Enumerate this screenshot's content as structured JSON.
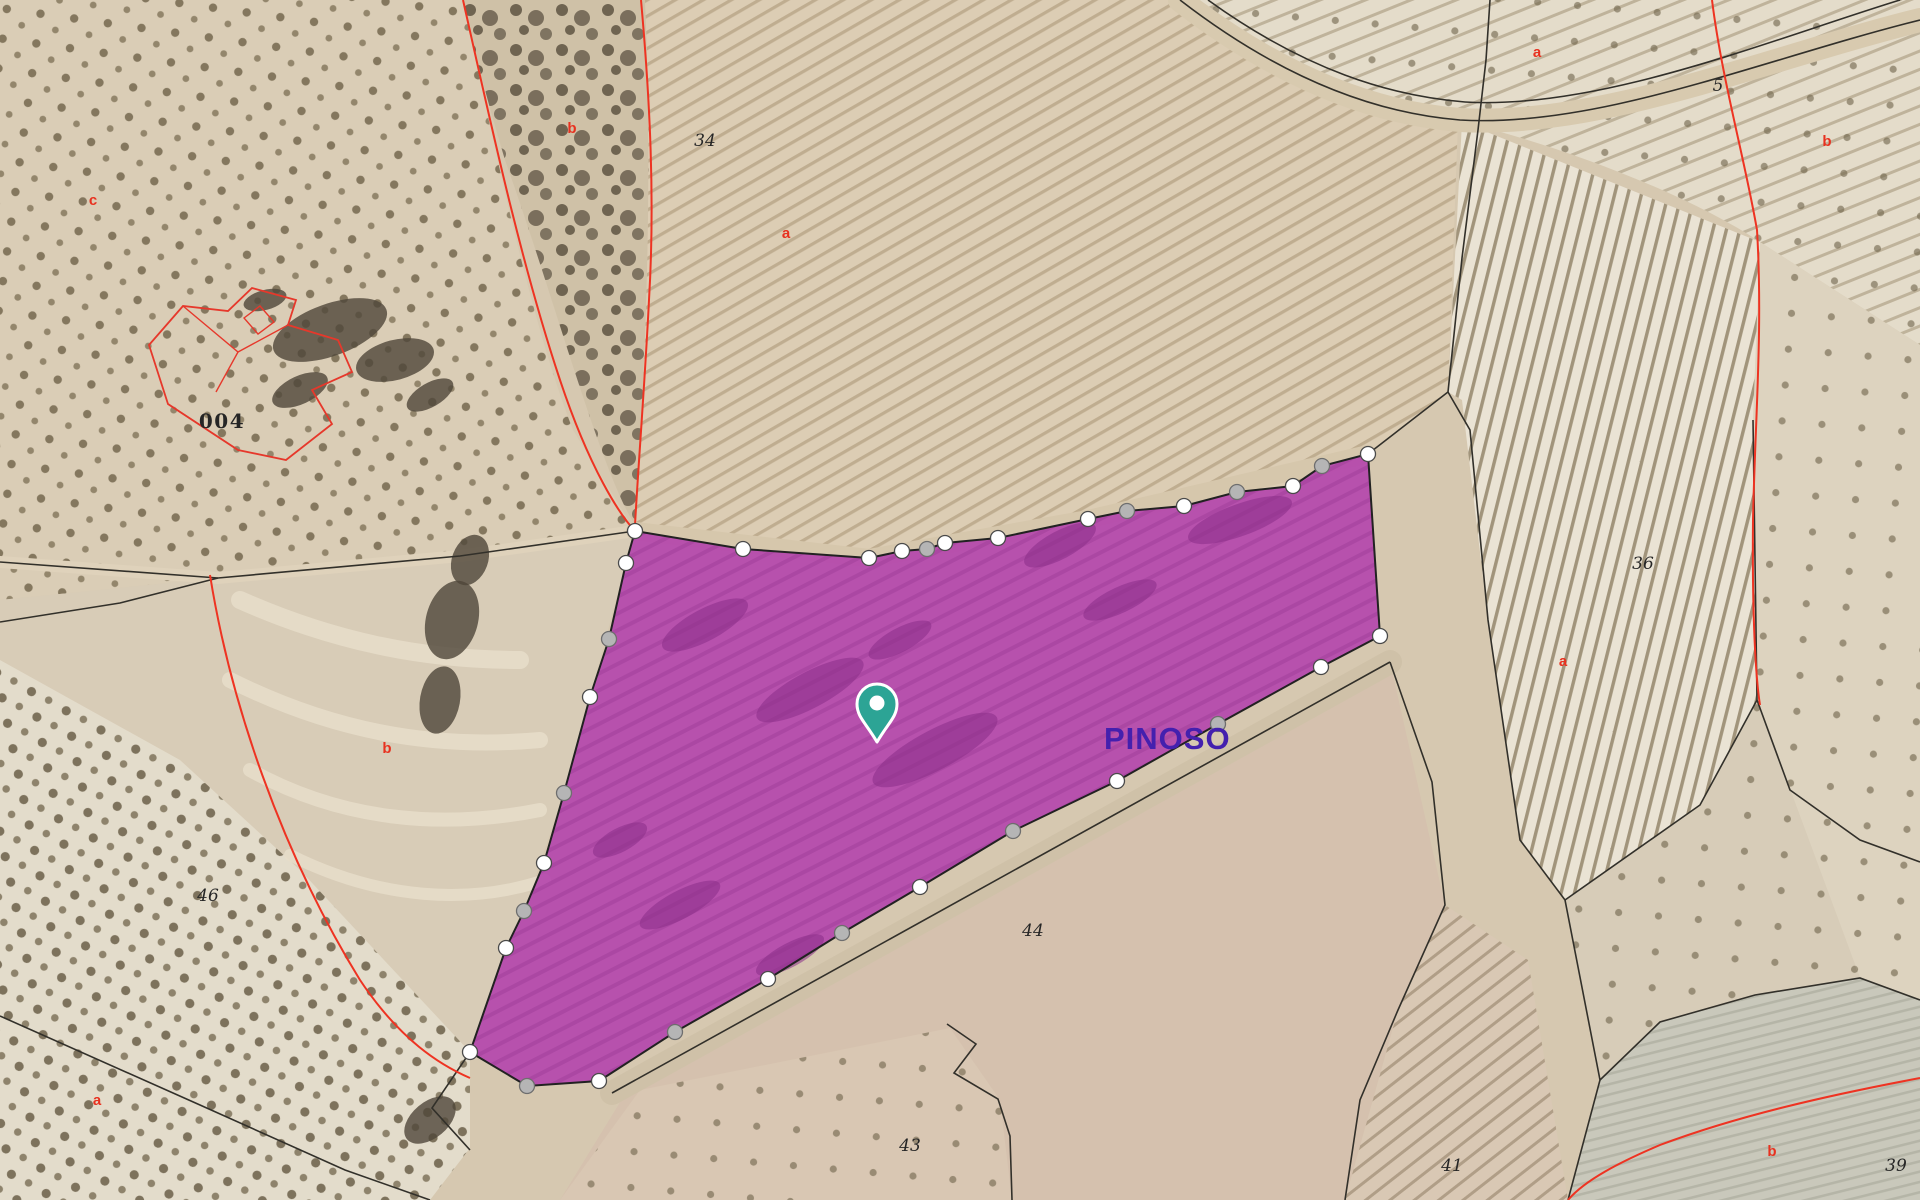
{
  "map": {
    "city_label": "PINOSO",
    "colors": {
      "base": "#d6c8b0",
      "parcel_fill": "#b340ac",
      "parcel_stroke": "#222222",
      "vertex_white": "#ffffff",
      "vertex_white_stroke": "#4a4a4a",
      "vertex_gray": "#b5b5b5",
      "vertex_gray_stroke": "#6e6e6e",
      "pin": "#2ca495",
      "pin_stroke": "#ffffff",
      "red_boundary": "#ee3322",
      "building_red": "#e6382b",
      "label_black": "#262626",
      "label_red": "#e8311f",
      "city_color": "#4420ae",
      "black_line": "#32302a",
      "purple_blob": "#8a2d89",
      "scrub_blob": "#4f4639"
    },
    "fields": [
      {
        "id": "olive-grove-nw",
        "path": "M0,0 L463,0 C495,150 530,320 573,430 L635,531 L460,556 L218,578 L0,600 Z",
        "fill": "#dacdb6",
        "patterns": [
          "olive"
        ]
      },
      {
        "id": "scrub-gully-top",
        "path": "M463,0 L645,0 C652,160 648,330 635,525 C600,470 555,300 505,160 C490,110 475,55 463,0 Z",
        "fill": "#cfc1a7",
        "patterns": [
          "scrub"
        ]
      },
      {
        "id": "field-34",
        "path": "M645,0 L1190,0 C1285,82 1385,114 1458,122 L1448,392 L1368,454 L1293,486 L1184,506 L1088,519 L998,538 L869,558 L743,549 L635,531 C648,330 652,160 645,0 Z",
        "fill": "#dccdb4",
        "patterns": [
          "rows34"
        ]
      },
      {
        "id": "olive-corner-ne",
        "path": "M1190,0 L1920,0 L1920,345 L1760,242 C1690,195 1560,145 1462,122 C1385,114 1285,82 1190,0 Z",
        "fill": "#e4dcca",
        "patterns": [
          "rowsTR",
          "oliveSparse"
        ]
      },
      {
        "id": "field-far-right",
        "path": "M1920,345 L1920,1000 L1860,978 L1757,700 L1753,420 L1760,242 Z",
        "fill": "#ddd3bf",
        "patterns": [
          "oliveSparse"
        ]
      },
      {
        "id": "vineyard-36",
        "path": "M1462,122 L1760,242 L1753,420 L1757,700 L1700,805 L1565,900 L1520,840 L1488,620 L1462,400 L1448,392 Z",
        "fill": "#eae3d4",
        "patterns": [
          "rows36"
        ]
      },
      {
        "id": "terraces-mid-left",
        "path": "M0,600 L218,578 L460,556 L635,531 L626,563 L590,697 L564,793 L524,911 L470,1052 L300,870 L180,760 L0,660 Z",
        "fill": "#d8ccb7",
        "patterns": []
      },
      {
        "id": "olive-grove-sw",
        "path": "M0,660 L180,760 L300,870 L470,1052 L470,1148 L430,1200 L0,1200 Z",
        "fill": "#e3dccb",
        "patterns": [
          "olive2"
        ]
      },
      {
        "id": "field-44",
        "path": "M630,1086 L1390,662 L1445,905 L1398,1010 L1345,1200 L560,1200 Z",
        "fill": "#d5c1ae",
        "patterns": []
      },
      {
        "id": "field-43",
        "path": "M560,1200 L640,1090 L950,1028 L1000,1100 L1012,1200 Z",
        "fill": "#d9c7b3",
        "patterns": [
          "oliveSparse"
        ]
      },
      {
        "id": "field-41",
        "path": "M1345,1200 L1398,1010 L1445,905 L1528,960 L1568,1200 Z",
        "fill": "#d9c8b4",
        "patterns": [
          "rows41"
        ]
      },
      {
        "id": "field-grey-se",
        "path": "M1568,1200 L1600,1080 L1660,1022 L1755,995 L1860,978 L1920,1000 L1920,1200 Z",
        "fill": "#c9c8bb",
        "patterns": [
          "rowsGrey"
        ]
      },
      {
        "id": "field-right-mid",
        "path": "M1757,700 L1860,978 L1755,995 L1660,1022 L1600,1080 L1565,900 L1700,805 Z",
        "fill": "#d7ccb8",
        "patterns": [
          "oliveSparse"
        ]
      }
    ],
    "tracks": [
      {
        "id": "road-ne",
        "path": "M1180,0 C1290,85 1385,114 1460,120 C1600,128 1760,60 1920,20",
        "color": "#d8caaf",
        "width": 24
      },
      {
        "id": "track-west",
        "path": "M0,562 L218,578 L460,556 L635,531",
        "color": "#dfd2bb",
        "width": 12
      },
      {
        "id": "track-parcel-top",
        "path": "M635,531 L869,558 L1088,519 L1368,454",
        "color": "#d6c7ac",
        "width": 18
      },
      {
        "id": "track-parcel-bottom",
        "path": "M612,1093 L1390,662",
        "color": "#cfc1a8",
        "width": 24
      }
    ],
    "terraces": [
      {
        "path": "M240,600 C330,640 420,660 520,660",
        "width": 18
      },
      {
        "path": "M230,680 C330,730 430,750 540,740",
        "width": 16
      },
      {
        "path": "M250,770 C340,820 440,830 540,810",
        "width": 14
      },
      {
        "path": "M290,855 C380,900 470,905 545,880",
        "width": 12
      }
    ],
    "black_lines": [
      "M0,562 L218,578 L460,556 L635,531",
      "M1368,454 L1448,392 L1462,258 L1478,130 L1486,60 L1490,0",
      "M0,622 L120,603 L218,578",
      "M0,1016 L200,1105 L345,1170 L430,1200",
      "M470,1052 L432,1108 L470,1150",
      "M612,1093 L1390,662",
      "M1390,662 L1432,782 L1445,905 L1398,1010 L1360,1100 L1345,1200",
      "M947,1024 L976,1044 L954,1073 L998,1099 L1010,1136 L1012,1200",
      "M1448,392 L1470,430 L1488,620 L1520,840 L1565,900 L1600,1080 L1568,1200",
      "M1565,900 L1700,805 L1757,700",
      "M1600,1080 L1660,1022 L1755,995 L1860,978 L1920,1000",
      "M1180,0 C1290,85 1385,114 1460,120 C1600,128 1760,60 1920,20",
      "M1208,0 C1305,70 1390,96 1465,102 C1600,110 1770,40 1900,0",
      "M1753,420 L1757,700 L1790,790 L1860,840 L1920,862"
    ],
    "red_lines": [
      "M463,0 C490,120 520,260 560,380 C590,470 620,515 635,531",
      "M641,0 C650,100 655,200 649,300 C645,380 638,470 635,525",
      "M1712,0 C1722,80 1745,160 1757,230 C1763,330 1755,420 1753,520 C1752,620 1756,680 1760,705",
      "M210,575 C230,700 280,850 360,980 C400,1040 440,1065 470,1078",
      "M1920,1078 C1830,1095 1740,1115 1660,1145 C1620,1162 1585,1180 1568,1200"
    ],
    "building": {
      "outline": "M149,345 L183,306 L228,311 L252,288 L296,300 L288,325 L338,340 L352,372 L312,390 L332,424 L286,460 L238,450 L168,404 Z",
      "inner": [
        "M183,306 L238,352 L288,325",
        "M238,352 L216,392",
        "M244,318 L260,306 L274,322 L258,334 Z",
        "M168,404 L238,450"
      ]
    },
    "scrub_blobs": [
      [
        330,
        330,
        60,
        26,
        -20
      ],
      [
        395,
        360,
        40,
        20,
        -15
      ],
      [
        300,
        390,
        30,
        14,
        -25
      ],
      [
        430,
        395,
        26,
        12,
        -30
      ],
      [
        265,
        300,
        22,
        10,
        -15
      ],
      [
        452,
        620,
        26,
        40,
        15
      ],
      [
        440,
        700,
        20,
        34,
        10
      ],
      [
        470,
        560,
        18,
        26,
        20
      ],
      [
        430,
        1120,
        30,
        18,
        -40
      ]
    ],
    "parcel": {
      "vertices": [
        [
          635,
          531,
          "w"
        ],
        [
          743,
          549,
          "w"
        ],
        [
          869,
          558,
          "w"
        ],
        [
          902,
          551,
          "w"
        ],
        [
          927,
          549,
          "g"
        ],
        [
          945,
          543,
          "w"
        ],
        [
          998,
          538,
          "w"
        ],
        [
          1088,
          519,
          "w"
        ],
        [
          1127,
          511,
          "g"
        ],
        [
          1184,
          506,
          "w"
        ],
        [
          1237,
          492,
          "g"
        ],
        [
          1293,
          486,
          "w"
        ],
        [
          1322,
          466,
          "g"
        ],
        [
          1368,
          454,
          "w"
        ],
        [
          1380,
          636,
          "w"
        ],
        [
          1321,
          667,
          "w"
        ],
        [
          1218,
          724,
          "g"
        ],
        [
          1117,
          781,
          "w"
        ],
        [
          1013,
          831,
          "g"
        ],
        [
          920,
          887,
          "w"
        ],
        [
          842,
          933,
          "g"
        ],
        [
          768,
          979,
          "w"
        ],
        [
          675,
          1032,
          "g"
        ],
        [
          599,
          1081,
          "w"
        ],
        [
          527,
          1086,
          "g"
        ],
        [
          470,
          1052,
          "w"
        ],
        [
          506,
          948,
          "w"
        ],
        [
          524,
          911,
          "g"
        ],
        [
          544,
          863,
          "w"
        ],
        [
          564,
          793,
          "g"
        ],
        [
          590,
          697,
          "w"
        ],
        [
          609,
          639,
          "g"
        ],
        [
          626,
          563,
          "w"
        ]
      ]
    },
    "purple_blobs": [
      [
        705,
        625,
        48,
        16,
        -28
      ],
      [
        810,
        690,
        60,
        18,
        -28
      ],
      [
        935,
        750,
        70,
        20,
        -28
      ],
      [
        1060,
        545,
        40,
        14,
        -28
      ],
      [
        1240,
        520,
        55,
        16,
        -20
      ],
      [
        680,
        905,
        45,
        14,
        -28
      ],
      [
        790,
        955,
        38,
        12,
        -28
      ],
      [
        620,
        840,
        30,
        12,
        -28
      ],
      [
        900,
        640,
        35,
        12,
        -28
      ],
      [
        1120,
        600,
        40,
        13,
        -25
      ]
    ],
    "pin": {
      "x": 877,
      "y": 742
    },
    "labels": [
      {
        "text": "34",
        "x": 705,
        "y": 146,
        "cls": "num"
      },
      {
        "text": "a",
        "x": 786,
        "y": 238,
        "cls": "red"
      },
      {
        "text": "b",
        "x": 572,
        "y": 133,
        "cls": "red"
      },
      {
        "text": "c",
        "x": 93,
        "y": 205,
        "cls": "red"
      },
      {
        "text": "004",
        "x": 222,
        "y": 428,
        "cls": "numbig"
      },
      {
        "text": "46",
        "x": 208,
        "y": 901,
        "cls": "num"
      },
      {
        "text": "b",
        "x": 387,
        "y": 753,
        "cls": "red"
      },
      {
        "text": "a",
        "x": 97,
        "y": 1105,
        "cls": "red"
      },
      {
        "text": "44",
        "x": 1033,
        "y": 936,
        "cls": "num"
      },
      {
        "text": "43",
        "x": 910,
        "y": 1151,
        "cls": "num"
      },
      {
        "text": "41",
        "x": 1452,
        "y": 1171,
        "cls": "num"
      },
      {
        "text": "39",
        "x": 1896,
        "y": 1171,
        "cls": "num"
      },
      {
        "text": "b",
        "x": 1772,
        "y": 1156,
        "cls": "red"
      },
      {
        "text": "36",
        "x": 1643,
        "y": 569,
        "cls": "num"
      },
      {
        "text": "a",
        "x": 1563,
        "y": 666,
        "cls": "red"
      },
      {
        "text": "a",
        "x": 1537,
        "y": 57,
        "cls": "red"
      },
      {
        "text": "5",
        "x": 1718,
        "y": 91,
        "cls": "num",
        "fs": 15
      },
      {
        "text": "b",
        "x": 1827,
        "y": 146,
        "cls": "red"
      },
      {
        "text": "PINOSO",
        "x": 1104,
        "y": 749,
        "cls": "city",
        "anchor": "start"
      }
    ]
  }
}
